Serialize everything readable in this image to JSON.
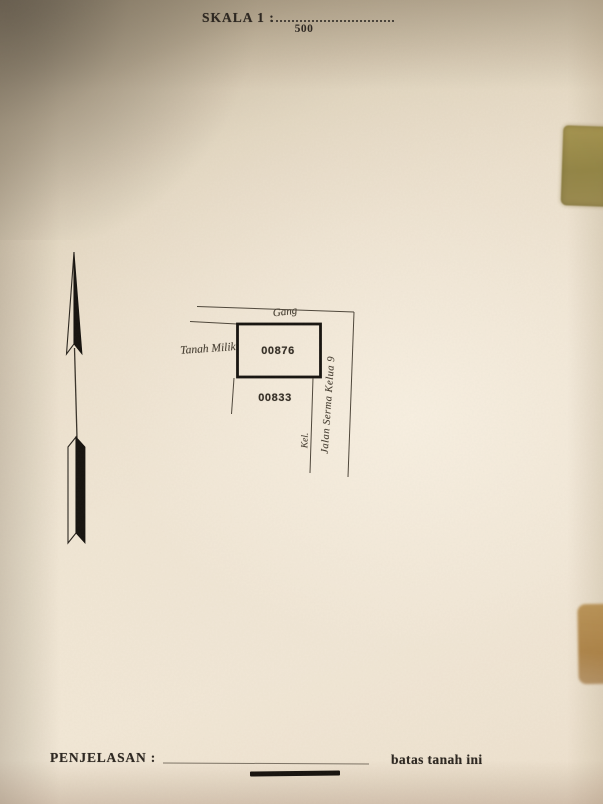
{
  "document": {
    "scale": {
      "label": "SKALA 1 :",
      "value": "500"
    },
    "map": {
      "alley_label": "Gang",
      "owner_label": "Tanah Milik",
      "parcel_number_main": "00876",
      "parcel_number_adjacent": "00833",
      "kelurahan_abbrev": "Kel.",
      "street_name": "Jalan Serma Kelua 9"
    },
    "legend": {
      "title": "PENJELASAN :",
      "boundary_description": "batas tanah ini"
    }
  },
  "colors": {
    "paper_light": "#f2e8d6",
    "paper_dark_corner": "#857b68",
    "ink_print": "#2c2620",
    "ink_hand": "#473f33",
    "line_thin": "#4e463a",
    "line_bold": "#16130f",
    "stain_olive": "#8f813f",
    "stain_brown": "#a8username2e"
  }
}
